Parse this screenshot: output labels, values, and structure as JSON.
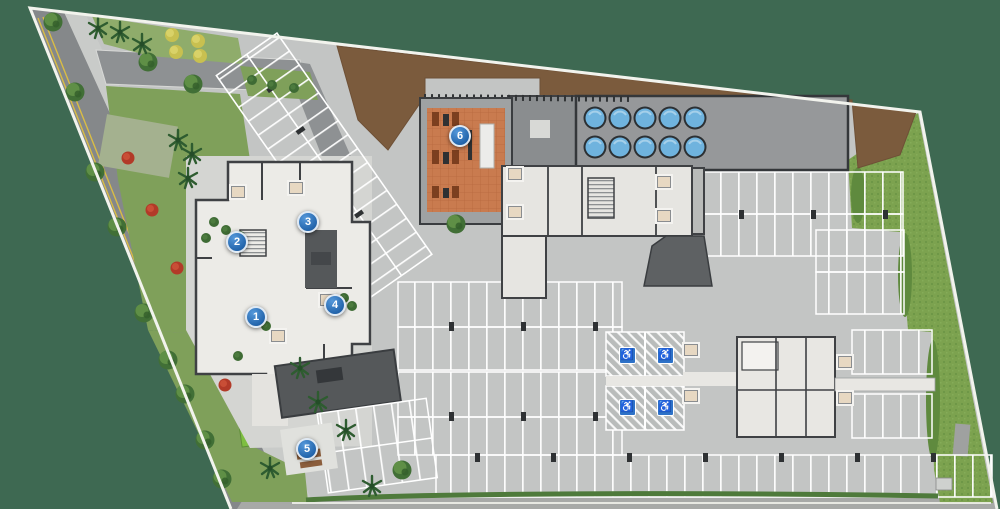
{
  "canvas": {
    "width": 1000,
    "height": 509,
    "description": "aerial ground-floor site plan illustration"
  },
  "markers": [
    {
      "label": "1"
    },
    {
      "label": "2"
    },
    {
      "label": "3"
    },
    {
      "label": "4"
    },
    {
      "label": "5"
    },
    {
      "label": "6"
    }
  ],
  "icons": {
    "accessible_glyph": "♿",
    "accessible_count": 4,
    "water_tank_count": 10
  },
  "palette": {
    "background": "#3E6952",
    "pavement": "#C3C5C4",
    "road": "#85888A",
    "sidewalk": "#C9CBC9",
    "lawn": "#7CA24F",
    "garden": "#7FA05A",
    "soil": "#7B5B3D",
    "deck": "#C97B4F",
    "building_floor": "#ECEBE7",
    "wall": "#3F4144",
    "dark_slab": "#55585A",
    "tank_blue": "#6FB3DE",
    "marker_blue": "#2B6CB8",
    "accessible_blue": "#2E72C8",
    "stripe_white": "#FFFFFF",
    "boundary_white": "#F2F3ED",
    "road_line_yellow": "#D9BC45"
  }
}
